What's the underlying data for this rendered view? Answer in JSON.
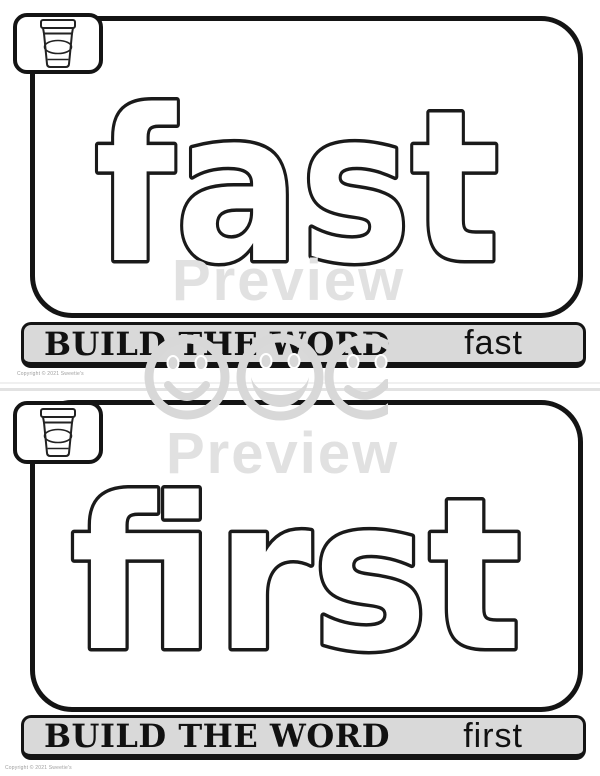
{
  "watermark": {
    "preview_label": "Preview",
    "smiley_icon": "smiley-face",
    "gray": "#e1e1e1"
  },
  "cards": [
    {
      "word": "fast",
      "build_label": "BUILD THE WORD",
      "icon": "playdough-cup",
      "copyright": "Copyright © 2021 Sweetie's"
    },
    {
      "word": "first",
      "build_label": "BUILD THE WORD",
      "icon": "playdough-cup",
      "copyright": "Copyright © 2021 Sweetie's"
    }
  ],
  "colors": {
    "outline": "#141414",
    "bar_background": "#d9d9d9",
    "bubble_fill": "#ffffff",
    "copyright_gray": "#9e9e9e"
  }
}
